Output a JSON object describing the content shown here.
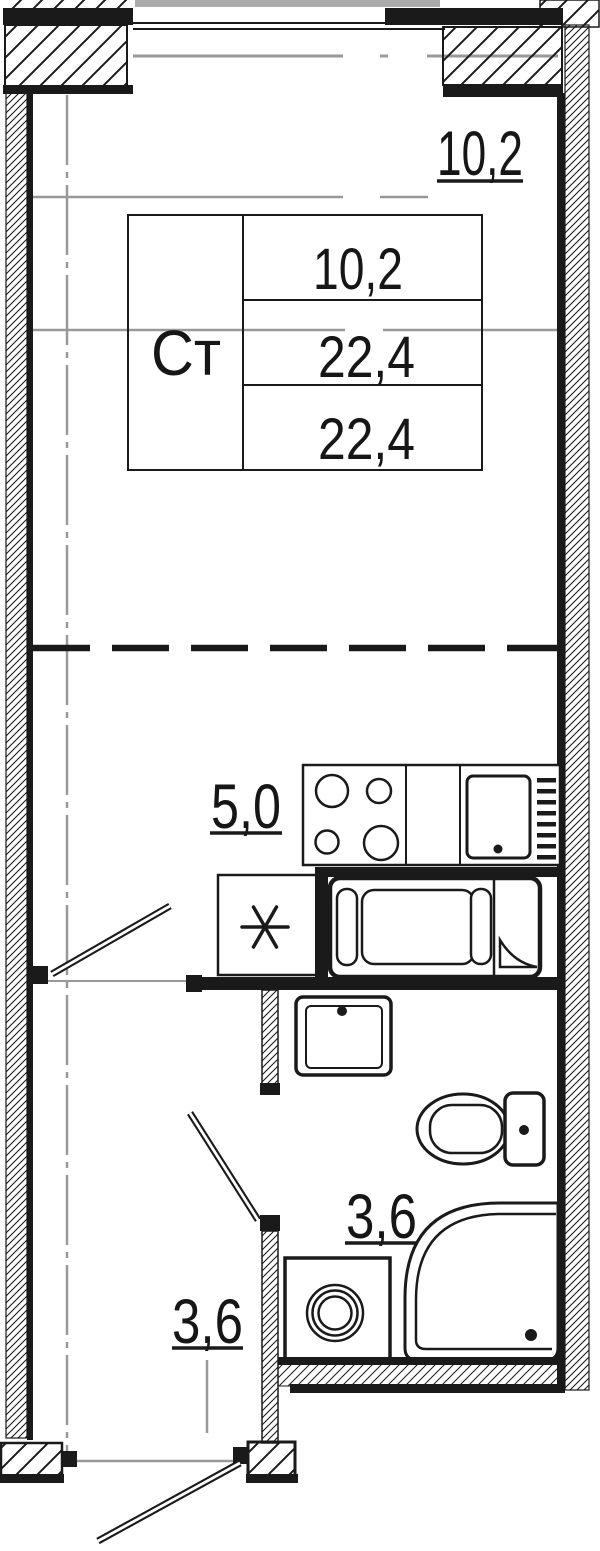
{
  "plan": {
    "unit_table": {
      "type_label": "Ст",
      "col2_rows": [
        "10,2",
        "22,4",
        "22,4"
      ]
    },
    "rooms": {
      "living": {
        "area_label": "10,2"
      },
      "kitchen": {
        "area_label": "5,0"
      },
      "bathroom": {
        "area_label": "3,6"
      },
      "hallway": {
        "area_label": "3,6"
      }
    },
    "fixtures": {
      "stove": "stove-4-burner",
      "fridge": "fridge",
      "fridge_spot": "asterisk-appliance-spot",
      "bathtub": "bathtub",
      "sink": "wash-basin",
      "toilet": "toilet",
      "shower": "shower-cabin-quarter-round",
      "washer": "washing-machine",
      "window": "window-opening",
      "entry": "entrance-door"
    },
    "colors": {
      "ink": "#1a1a1a",
      "guide_gray": "#999999",
      "exterior_gray": "#aaaaaa",
      "paper": "#ffffff"
    }
  }
}
